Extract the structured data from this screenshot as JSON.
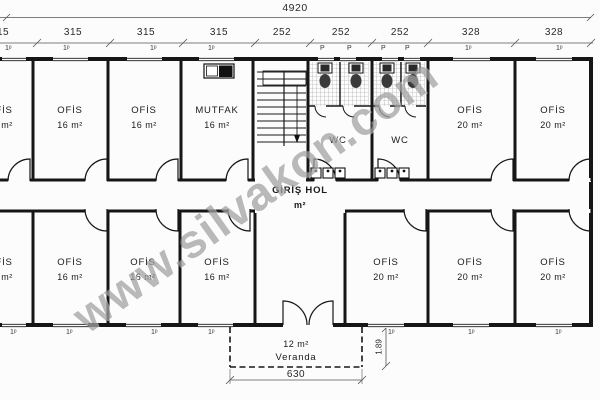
{
  "watermark": "www.silvakon.com",
  "dimensions": {
    "overall_width": "4920",
    "segments": [
      "315",
      "315",
      "315",
      "315",
      "252",
      "252",
      "252",
      "328",
      "328"
    ],
    "veranda_width": "630",
    "veranda_depth": "1.89",
    "window_mark": "1ᵖ",
    "wc_mark": "P"
  },
  "rooms": [
    {
      "name": "OFİS",
      "area": "16 m²"
    },
    {
      "name": "OFİS",
      "area": "16 m²"
    },
    {
      "name": "OFİS",
      "area": "16 m²"
    },
    {
      "name": "MUTFAK",
      "area": "16 m²"
    },
    {
      "name": "WC",
      "area": ""
    },
    {
      "name": "WC",
      "area": ""
    },
    {
      "name": "OFİS",
      "area": "20 m²"
    },
    {
      "name": "OFİS",
      "area": "20 m²"
    },
    {
      "name": "OFİS",
      "area": "16 m²"
    },
    {
      "name": "OFİS",
      "area": "16 m²"
    },
    {
      "name": "OFİS",
      "area": "16 m²"
    },
    {
      "name": "OFİS",
      "area": "16 m²"
    },
    {
      "name": "OFİS",
      "area": "20 m²"
    },
    {
      "name": "OFİS",
      "area": "20 m²"
    },
    {
      "name": "OFİS",
      "area": "20 m²"
    }
  ],
  "hall": {
    "name": "GİRİŞ HOL",
    "area": "m²"
  },
  "veranda": {
    "area": "12 m²",
    "name": "Veranda"
  }
}
